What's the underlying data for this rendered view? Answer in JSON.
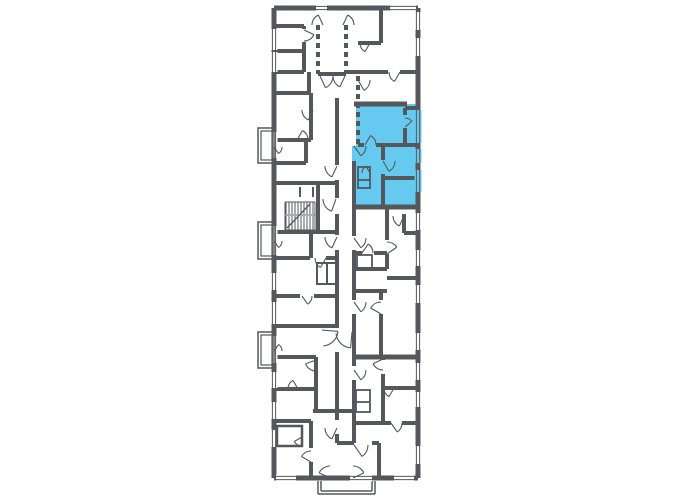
{
  "page": {
    "background": "#ffffff",
    "description": "apartment-building-floor-plan",
    "selected_apartment": {
      "label": "highlighted-unit",
      "color": "#66C9F0"
    }
  },
  "colors": {
    "wall": "#54585C",
    "highlight": "#66C9F0",
    "background": "#ffffff"
  },
  "plan": {
    "canvas": {
      "w": 680,
      "h": 500
    },
    "fills": [
      {
        "name": "selected-apartment",
        "points": "356,104 418,104 418,207 352,207 352,146 356,146",
        "color": "#66C9F0"
      }
    ],
    "hatch": [
      {
        "x": 286,
        "y": 202,
        "w": 28,
        "h": 12,
        "step": 3
      },
      {
        "x": 286,
        "y": 216,
        "w": 28,
        "h": 14,
        "step": 3
      }
    ],
    "walls": [
      [
        274,
        8,
        418,
        8,
        5
      ],
      [
        418,
        8,
        418,
        478,
        5
      ],
      [
        274,
        478,
        418,
        478,
        5
      ],
      [
        274,
        8,
        274,
        478,
        5
      ],
      [
        276,
        26,
        304,
        26,
        4
      ],
      [
        304,
        26,
        304,
        29,
        4
      ],
      [
        304,
        42,
        304,
        72,
        4
      ],
      [
        276,
        51,
        304,
        51,
        4
      ],
      [
        276,
        72,
        304,
        72,
        4
      ],
      [
        309,
        72,
        309,
        93,
        4
      ],
      [
        276,
        93,
        309,
        93,
        4
      ],
      [
        311,
        93,
        311,
        140,
        4
      ],
      [
        276,
        140,
        311,
        140,
        4
      ],
      [
        276,
        163,
        306,
        163,
        4
      ],
      [
        306,
        140,
        306,
        163,
        4
      ],
      [
        276,
        183,
        337,
        183,
        4
      ],
      [
        318,
        183,
        318,
        232,
        4
      ],
      [
        300,
        187,
        300,
        197,
        2
      ],
      [
        313,
        187,
        313,
        197,
        2
      ],
      [
        276,
        232,
        337,
        232,
        4
      ],
      [
        311,
        232,
        311,
        258,
        4
      ],
      [
        276,
        258,
        310,
        258,
        4
      ],
      [
        326,
        258,
        337,
        258,
        4
      ],
      [
        276,
        296,
        300,
        296,
        4
      ],
      [
        314,
        296,
        337,
        296,
        4
      ],
      [
        276,
        326,
        337,
        326,
        4
      ],
      [
        276,
        357,
        316,
        357,
        4
      ],
      [
        316,
        357,
        316,
        411,
        4
      ],
      [
        276,
        389,
        316,
        389,
        4
      ],
      [
        313,
        411,
        356,
        411,
        4
      ],
      [
        276,
        421,
        311,
        421,
        4
      ],
      [
        311,
        421,
        311,
        448,
        4
      ],
      [
        311,
        462,
        311,
        478,
        4
      ],
      [
        318,
        74,
        346,
        74,
        4
      ],
      [
        337,
        98,
        337,
        165,
        4
      ],
      [
        337,
        180,
        337,
        198,
        4
      ],
      [
        337,
        214,
        337,
        235,
        4
      ],
      [
        337,
        250,
        337,
        328,
        4
      ],
      [
        337,
        352,
        337,
        420,
        4
      ],
      [
        337,
        434,
        337,
        443,
        4
      ],
      [
        354,
        161,
        354,
        236,
        4
      ],
      [
        354,
        250,
        354,
        300,
        4
      ],
      [
        354,
        314,
        354,
        366,
        4
      ],
      [
        354,
        380,
        354,
        443,
        4
      ],
      [
        337,
        443,
        354,
        443,
        4
      ],
      [
        372,
        443,
        379,
        443,
        4
      ],
      [
        379,
        443,
        379,
        478,
        4
      ],
      [
        358,
        43,
        381,
        43,
        4
      ],
      [
        381,
        10,
        381,
        43,
        4
      ],
      [
        346,
        72,
        388,
        72,
        4
      ],
      [
        400,
        72,
        418,
        72,
        4
      ],
      [
        354,
        104,
        407,
        104,
        5
      ],
      [
        405,
        108,
        418,
        108,
        4
      ],
      [
        405,
        108,
        405,
        115,
        4
      ],
      [
        405,
        128,
        405,
        145,
        4
      ],
      [
        358,
        145,
        364,
        145,
        4
      ],
      [
        376,
        145,
        418,
        145,
        4
      ],
      [
        383,
        145,
        383,
        160,
        4
      ],
      [
        383,
        174,
        383,
        207,
        4
      ],
      [
        383,
        178,
        418,
        178,
        4
      ],
      [
        352,
        207,
        418,
        207,
        5
      ],
      [
        404,
        214,
        404,
        233,
        4
      ],
      [
        404,
        233,
        418,
        233,
        4
      ],
      [
        354,
        253,
        362,
        253,
        4
      ],
      [
        374,
        253,
        387,
        253,
        4
      ],
      [
        354,
        269,
        387,
        269,
        4
      ],
      [
        387,
        207,
        387,
        240,
        4
      ],
      [
        387,
        254,
        387,
        269,
        4
      ],
      [
        387,
        278,
        418,
        278,
        4
      ],
      [
        354,
        291,
        387,
        291,
        4
      ],
      [
        381,
        291,
        381,
        300,
        4
      ],
      [
        381,
        314,
        381,
        357,
        4
      ],
      [
        354,
        357,
        418,
        357,
        5
      ],
      [
        383,
        357,
        383,
        360,
        4
      ],
      [
        383,
        374,
        383,
        423,
        4
      ],
      [
        383,
        388,
        418,
        388,
        4
      ],
      [
        354,
        423,
        391,
        423,
        4
      ],
      [
        402,
        423,
        418,
        423,
        4
      ],
      [
        358,
        180,
        370,
        180,
        1.8
      ],
      [
        327,
        263,
        327,
        284,
        2
      ],
      [
        356,
        402,
        370,
        402,
        1.8
      ],
      [
        285,
        202,
        315,
        202,
        1
      ],
      [
        285,
        215,
        315,
        215,
        1
      ],
      [
        285,
        230,
        315,
        230,
        1
      ],
      [
        285,
        202,
        285,
        230,
        1
      ],
      [
        315,
        202,
        315,
        230,
        1
      ],
      [
        287,
        228,
        310,
        204,
        1.3
      ],
      [
        318,
        481,
        318,
        494,
        1.5
      ],
      [
        318,
        494,
        375,
        494,
        1.5
      ],
      [
        375,
        481,
        375,
        494,
        1.5
      ],
      [
        321,
        481,
        321,
        491,
        1.5
      ],
      [
        321,
        491,
        372,
        491,
        1.5
      ],
      [
        372,
        481,
        372,
        491,
        1.5
      ]
    ],
    "dashed_walls": [
      [
        318,
        25,
        318,
        74,
        4
      ],
      [
        346,
        25,
        346,
        74,
        4
      ],
      [
        358,
        76,
        358,
        145,
        4
      ]
    ],
    "rects": [
      [
        258,
        128,
        16,
        35,
        1.5
      ],
      [
        261,
        131,
        11,
        29,
        1.2
      ],
      [
        258,
        222,
        16,
        37,
        1.5
      ],
      [
        261,
        225,
        11,
        31,
        1.2
      ],
      [
        258,
        332,
        16,
        36,
        1.5
      ],
      [
        261,
        335,
        11,
        30,
        1.2
      ],
      [
        358,
        167,
        12,
        21,
        1.8
      ],
      [
        317,
        263,
        19,
        21,
        2
      ],
      [
        277,
        426,
        25,
        20,
        2.5
      ],
      [
        356,
        390,
        14,
        22,
        1.8
      ],
      [
        357,
        255,
        15,
        13,
        1.8
      ]
    ],
    "windows": [
      {
        "x": 274,
        "y": 29,
        "len": 21,
        "dir": "v"
      },
      {
        "x": 274,
        "y": 52,
        "len": 20,
        "dir": "v"
      },
      {
        "x": 274,
        "y": 132,
        "len": 26,
        "dir": "v"
      },
      {
        "x": 274,
        "y": 226,
        "len": 29,
        "dir": "v"
      },
      {
        "x": 274,
        "y": 273,
        "len": 17,
        "dir": "v"
      },
      {
        "x": 274,
        "y": 302,
        "len": 22,
        "dir": "v"
      },
      {
        "x": 274,
        "y": 336,
        "len": 27,
        "dir": "v"
      },
      {
        "x": 274,
        "y": 372,
        "len": 16,
        "dir": "v"
      },
      {
        "x": 274,
        "y": 402,
        "len": 17,
        "dir": "v"
      },
      {
        "x": 274,
        "y": 430,
        "len": 17,
        "dir": "v"
      },
      {
        "x": 418,
        "y": 12,
        "len": 18,
        "dir": "v"
      },
      {
        "x": 418,
        "y": 38,
        "len": 18,
        "dir": "v"
      },
      {
        "x": 418,
        "y": 110,
        "len": 33,
        "dir": "v",
        "bg": "#66C9F0"
      },
      {
        "x": 418,
        "y": 149,
        "len": 14,
        "dir": "v",
        "bg": "#66C9F0"
      },
      {
        "x": 418,
        "y": 170,
        "len": 22,
        "dir": "v",
        "bg": "#66C9F0"
      },
      {
        "x": 418,
        "y": 213,
        "len": 17,
        "dir": "v"
      },
      {
        "x": 418,
        "y": 250,
        "len": 16,
        "dir": "v"
      },
      {
        "x": 418,
        "y": 285,
        "len": 18,
        "dir": "v"
      },
      {
        "x": 418,
        "y": 333,
        "len": 17,
        "dir": "v"
      },
      {
        "x": 418,
        "y": 363,
        "len": 17,
        "dir": "v"
      },
      {
        "x": 418,
        "y": 392,
        "len": 15,
        "dir": "v"
      },
      {
        "x": 418,
        "y": 446,
        "len": 18,
        "dir": "v"
      },
      {
        "x": 316,
        "y": 8,
        "len": 11,
        "dir": "h"
      },
      {
        "x": 390,
        "y": 8,
        "len": 26,
        "dir": "h"
      },
      {
        "x": 276,
        "y": 478,
        "len": 20,
        "dir": "h"
      },
      {
        "x": 350,
        "y": 478,
        "len": 22,
        "dir": "h"
      },
      {
        "x": 394,
        "y": 478,
        "len": 20,
        "dir": "h"
      }
    ],
    "doors": [
      [
        323,
        25,
        11,
        180,
        115
      ],
      [
        343,
        25,
        11,
        0,
        65
      ],
      [
        320,
        76,
        13,
        0,
        -65
      ],
      [
        345,
        76,
        12,
        180,
        245
      ],
      [
        304,
        30,
        11,
        -90,
        -25
      ],
      [
        358,
        80,
        12,
        0,
        -60
      ],
      [
        370,
        43,
        10,
        180,
        240
      ],
      [
        400,
        72,
        11,
        180,
        240
      ],
      [
        354,
        146,
        12,
        0,
        -55
      ],
      [
        365,
        145,
        11,
        0,
        60
      ],
      [
        383,
        161,
        12,
        0,
        -60
      ],
      [
        370,
        173,
        8,
        180,
        120
      ],
      [
        405,
        127,
        9,
        90,
        40
      ],
      [
        354,
        238,
        12,
        0,
        -55
      ],
      [
        404,
        216,
        11,
        180,
        245
      ],
      [
        362,
        253,
        11,
        0,
        55
      ],
      [
        387,
        254,
        12,
        90,
        35
      ],
      [
        354,
        302,
        12,
        0,
        -55
      ],
      [
        381,
        314,
        12,
        90,
        150
      ],
      [
        322,
        330,
        16,
        -85,
        -5
      ],
      [
        352,
        332,
        16,
        185,
        265
      ],
      [
        354,
        370,
        12,
        0,
        -55
      ],
      [
        383,
        359,
        11,
        -90,
        -155
      ],
      [
        394,
        388,
        10,
        180,
        240
      ],
      [
        391,
        423,
        11,
        0,
        -55
      ],
      [
        354,
        445,
        14,
        0,
        -55
      ],
      [
        330,
        478,
        12,
        90,
        155
      ],
      [
        353,
        478,
        12,
        90,
        25
      ],
      [
        337,
        166,
        12,
        180,
        245
      ],
      [
        336,
        199,
        13,
        180,
        250
      ],
      [
        313,
        110,
        11,
        180,
        245
      ],
      [
        297,
        140,
        11,
        0,
        60
      ],
      [
        274,
        147,
        8,
        0,
        -55
      ],
      [
        274,
        241,
        8,
        0,
        -55
      ],
      [
        274,
        351,
        8,
        0,
        55
      ],
      [
        337,
        237,
        12,
        180,
        245
      ],
      [
        326,
        258,
        11,
        180,
        240
      ],
      [
        302,
        296,
        10,
        0,
        -55
      ],
      [
        316,
        360,
        11,
        -90,
        -160
      ],
      [
        298,
        389,
        10,
        180,
        120
      ],
      [
        337,
        428,
        12,
        180,
        245
      ],
      [
        302,
        437,
        9,
        -90,
        -150
      ],
      [
        311,
        462,
        11,
        90,
        150
      ]
    ]
  }
}
